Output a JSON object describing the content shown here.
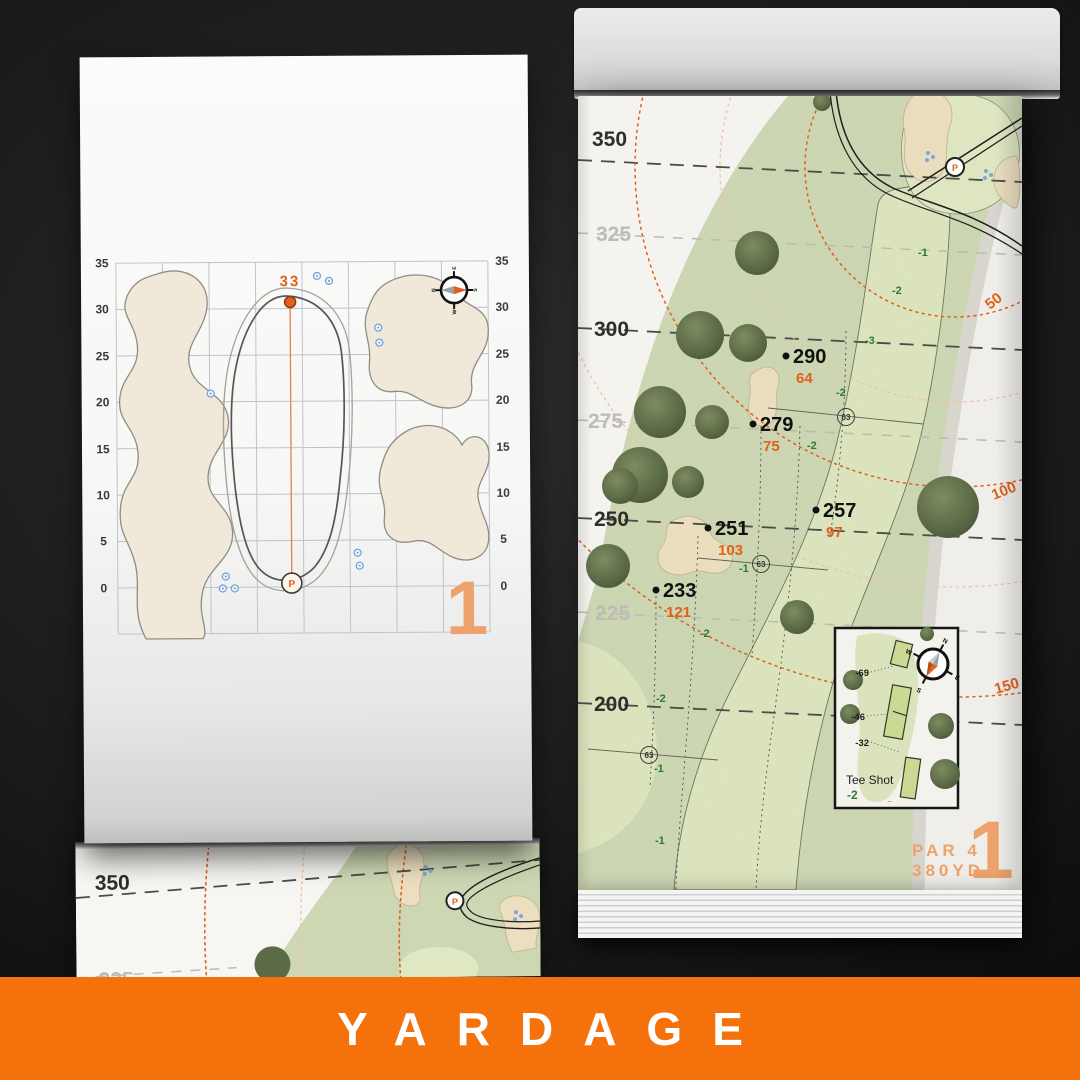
{
  "footer": {
    "title": "YARDAGE"
  },
  "colors": {
    "accent_orange": "#e0601c",
    "band_orange": "#f4710b",
    "muted_orange": "#eda26b",
    "slope_green": "#2d7a33",
    "rough_green": "#cdd7b4",
    "fairway_green": "#dde5bf",
    "bunker_sand": "#ecdfc0",
    "sprinkler_blue": "#6f9fd6"
  },
  "left_page": {
    "hole_number": "1",
    "green_depth": "33",
    "pin": "P",
    "axis_ticks": [
      "35",
      "30",
      "25",
      "20",
      "15",
      "10",
      "5",
      "0"
    ],
    "compass": {
      "n": "N",
      "e": "E",
      "s": "S",
      "w": "W"
    }
  },
  "right_page": {
    "hole_number": "1",
    "par": "PAR 4",
    "yardage": "380YD",
    "pin": "P",
    "major_lines": [
      "350",
      "300",
      "250",
      "200"
    ],
    "minor_lines": [
      "325",
      "275",
      "225"
    ],
    "arc_labels": [
      "50",
      "100",
      "150"
    ],
    "points": [
      {
        "carry": "290",
        "remaining": "64"
      },
      {
        "carry": "279",
        "remaining": "75"
      },
      {
        "carry": "257",
        "remaining": "97"
      },
      {
        "carry": "251",
        "remaining": "103"
      },
      {
        "carry": "233",
        "remaining": "121"
      }
    ],
    "slopes": [
      "-1",
      "-2",
      "-3",
      "-2",
      "-2",
      "-1",
      "-2",
      "-2",
      "-1",
      "-1"
    ],
    "sprinkler_marks": [
      "63",
      "63",
      "63"
    ],
    "tee_inset": {
      "title": "Tee Shot",
      "slope": "-2",
      "markers": [
        "-69",
        "-46",
        "-32"
      ],
      "compass": {
        "n": "N",
        "e": "E",
        "s": "S",
        "w": "W"
      }
    }
  },
  "bottom_page": {
    "major_line": "350",
    "minor_line": "325",
    "pin": "P"
  }
}
